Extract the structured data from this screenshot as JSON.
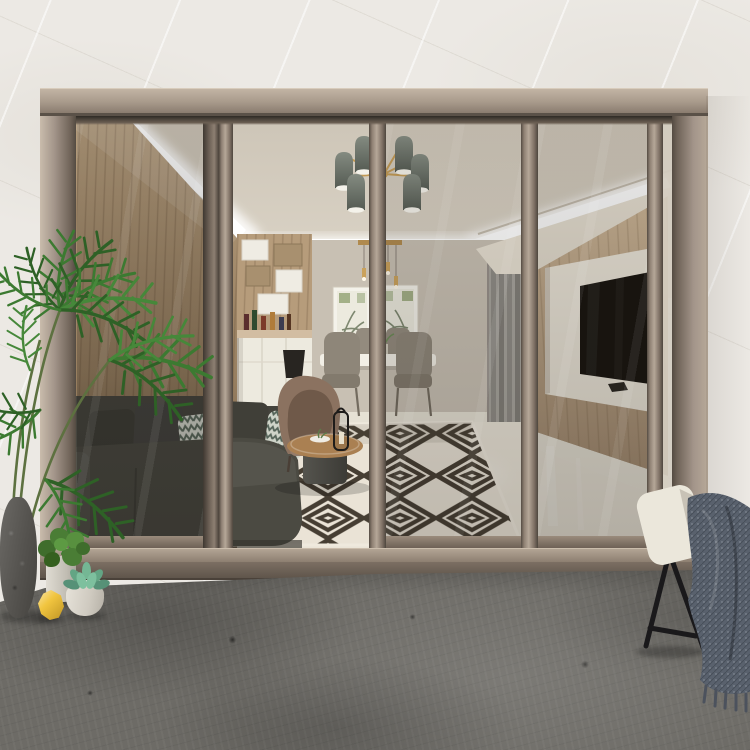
{
  "meta": {
    "kind": "photograph",
    "subject": "Modern living room seen through a four-panel bronze aluminium sliding glass patio door, with the middle leaf open onto a grey concrete patio",
    "width_px": 750,
    "height_px": 750
  },
  "palette": {
    "exterior_wall": "#ece9e4",
    "concrete_floor": "#6d6b66",
    "frame_light": "#c2b4a4",
    "frame_mid": "#9c8e80",
    "frame_dark": "#574e44",
    "ceiling": "#d8d1c4",
    "led_strip": "#ffffff",
    "back_wall": "#c8c0b3",
    "wood_wall_left": "#a58a68",
    "wood_wall_right": "#c3ac8e",
    "interior_floor": "#eae4d7",
    "rug_light": "#eae3d6",
    "rug_dark": "#463e33",
    "sofa": "#4b4a42",
    "pillow_pattern_bg": "#d9dcd2",
    "pillow_pattern_stripe": "#5c6b5e",
    "armchair": "#8b7260",
    "coffee_table_top": "#aa8052",
    "coffee_table_base": "#4c4b45",
    "dining_chair": "#8e8679",
    "tv_panel": "#efe9dc",
    "tv_screen": "#17130e",
    "curtain_panel": "#a7a49d",
    "shelving_wood": "#b69c7b",
    "cabinet_white": "#edeadf",
    "lamp_shade": "#282521",
    "chandelier_shade": "#6e756c",
    "brass_accent": "#c29a55",
    "palm_green": "#3c7a31",
    "palm_dark_green": "#2e6126",
    "stone_pot": "#5a5854",
    "white_pot": "#dcd8cf",
    "succulent_green": "#63a584",
    "lemon_yellow": "#f1c53f",
    "patio_chair_cushion": "#ebe7db",
    "patio_chair_legs": "#1a191b",
    "throw_blanket": "#59616d"
  },
  "objects": [
    "marble-look exterior wall",
    "bronze four-panel sliding glass door (one leaf open)",
    "recessed ceiling cove with white LED strip",
    "six-shade grey and brass chandelier",
    "brass mini pendant cluster over dining table",
    "two framed botanical prints",
    "white dining table with grey upholstered chairs",
    "wood and white open shelving with bottles and sideboard",
    "dark charcoal sectional sofa with patterned pillows",
    "brown fabric armchair",
    "round wood coffee table with black lantern",
    "black and white concentric-diamond rug",
    "wood slat TV wall with white media panel and flat-screen TV",
    "interior glass door with grey curtain panels",
    "tall potted palm in stone planter",
    "small potted bush, succulent bowl and yellow ornament",
    "cream outdoor chair with black legs and grey knit throw",
    "grey concrete patio floor"
  ]
}
